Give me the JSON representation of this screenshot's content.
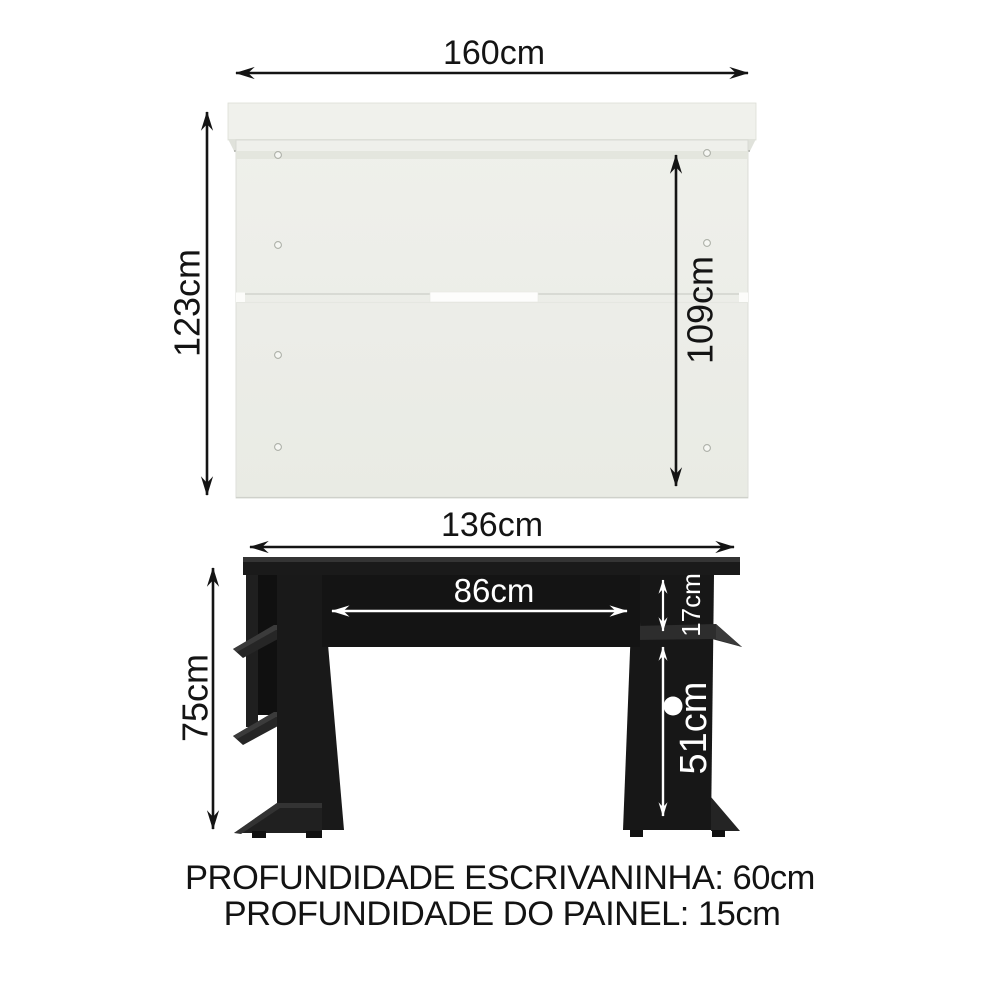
{
  "panel_view": {
    "name": "painel (top section)",
    "width": "160cm",
    "height": "123cm",
    "inner_height": "109cm"
  },
  "desk_view": {
    "name": "escrivaninha (desk section)",
    "width": "136cm",
    "height": "75cm",
    "inner_width": "86cm",
    "shelf_gap_height": "17cm",
    "under_top_height": "51cm"
  },
  "footer": {
    "depth_desk": "PROFUNDIDADE ESCRIVANINHA: 60cm",
    "depth_panel": "PROFUNDIDADE DO PAINEL: 15cm"
  },
  "colors": {
    "background": "#ffffff",
    "panel_fill": "#edeee9",
    "desk_fill": "#1a1a1a",
    "dimension_dark": "#141414",
    "dimension_light": "#ffffff"
  }
}
